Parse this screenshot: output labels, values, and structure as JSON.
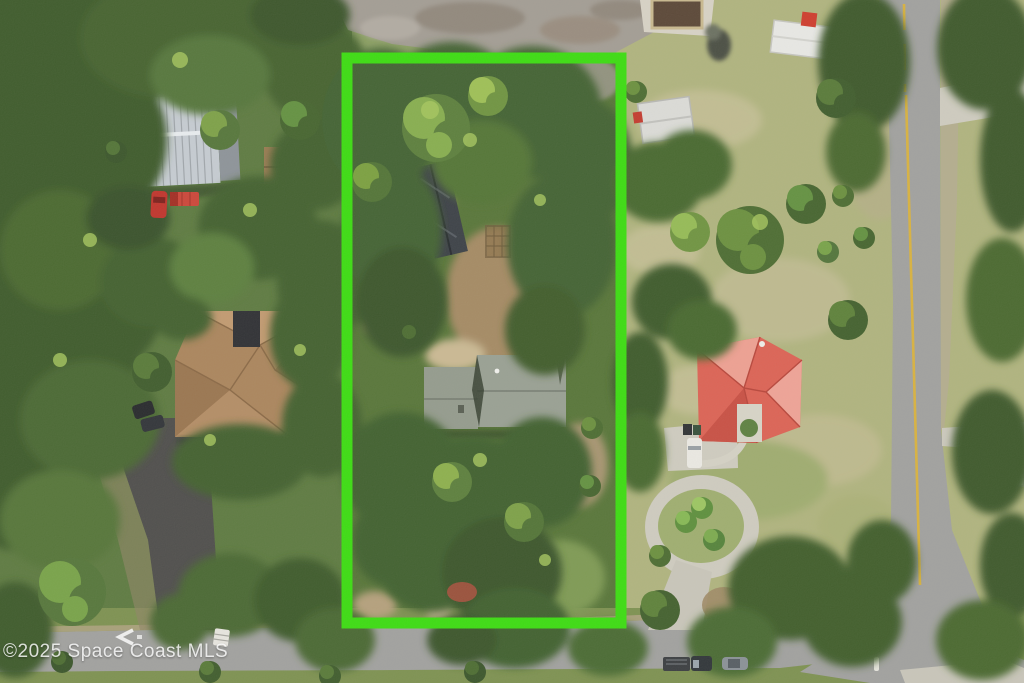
{
  "watermark": {
    "text": "©2025 Space Coast MLS"
  },
  "colors": {
    "boundary_green": "#3bdd10",
    "canopy_dark": "#3a552a",
    "canopy_mid": "#527436",
    "canopy_light": "#7da147",
    "lawn_tan_green": "#b0b47e",
    "road_asphalt": "#a1a19f",
    "road_line_yellow": "#d9b23e",
    "dark_asphalt_driveway": "#4e4d4b",
    "concrete": "#cfccc0",
    "gravel": "#a39d94",
    "metal_roof_silver": "#c6ccd2",
    "brown_shingle_roof": "#ab855c",
    "sage_green_roof": "#949b8d",
    "red_tile_roof": "#dd6254",
    "dark_shed_roof": "#3b4046",
    "watermark_white": "rgba(255,255,255,0.82)"
  }
}
